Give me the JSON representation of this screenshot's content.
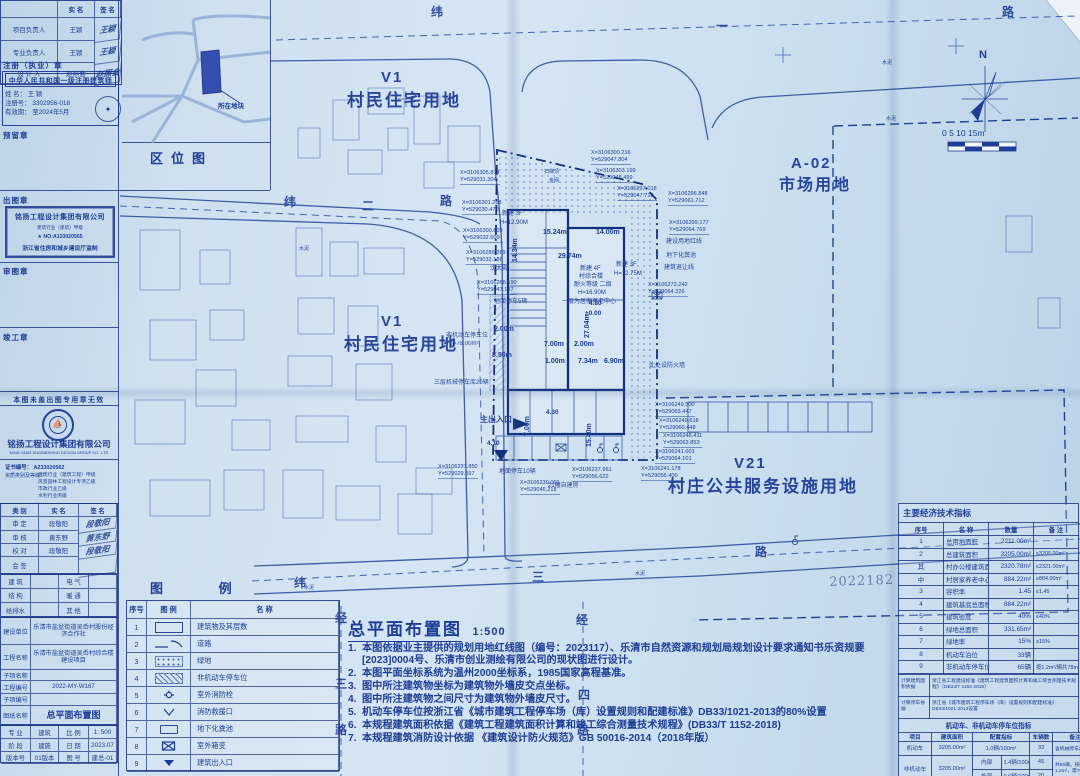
{
  "title_block": {
    "sign_table": {
      "headers": [
        "",
        "实 名",
        "签 名"
      ],
      "rows": [
        [
          "项目负责人",
          "王颖",
          "王颖"
        ],
        [
          "专业负责人",
          "王颖",
          "王颖"
        ],
        [
          "设 计 人",
          "赵照会",
          "赵照会"
        ]
      ]
    },
    "reg_stamp_label": "注册（执业）章",
    "reg_stamp": {
      "title": "中华人民共和国一级注册建筑师",
      "name": "姓 名： 王 颖",
      "no": "注册号： 3302956-018",
      "valid": "有效期： 至2024年5月"
    },
    "reserved_stamp_label": "预留章",
    "chutu_label": "出图章",
    "chutu_stamp": {
      "company": "铭扬工程设计集团有限公司",
      "grade": "建筑行业（建筑）甲级",
      "no": "★ NO:A133020565",
      "footer": "浙江省住房和城乡建设厅监制"
    },
    "shentu_label": "审图章",
    "jungong_label": "竣工章",
    "warning": "本图未盖出图专用章无效",
    "company_cn": "铭扬工程设计集团有限公司",
    "company_en": "MING YANG ENGINEERING DESIGN GROUP CO. ,LTD",
    "cert_no": "证书编号： A233020562",
    "cert_grade_label": "资质类别及等级：",
    "cert_grades": [
      "建筑行业（建筑工程）甲级",
      "风景园林工程设计专项乙级",
      "市政行业乙级",
      "水利行业丙级"
    ],
    "review_table": {
      "headers": [
        "类 别",
        "实 名",
        "签 名"
      ],
      "rows": [
        [
          "审 定",
          "段敬阳",
          "段敬阳"
        ],
        [
          "审 核",
          "黄东野",
          "黄东野"
        ],
        [
          "校 对",
          "段敬阳",
          "段敬阳"
        ],
        [
          "会 签",
          "",
          ""
        ]
      ]
    },
    "discipline_rows": [
      [
        "建 筑",
        "",
        "电 气",
        ""
      ],
      [
        "结 构",
        "",
        "暖 通",
        ""
      ],
      [
        "给排水",
        "",
        "其 他",
        ""
      ]
    ],
    "project_rows": [
      [
        "建设单位",
        "乐清市盐盆街道吴岙村股份经济合作社"
      ],
      [
        "工程名称",
        "乐清市盐盆街道吴岙村综合楼建设项目"
      ],
      [
        "子项名称",
        ""
      ],
      [
        "工程编号",
        "2022-MY-W167"
      ],
      [
        "子项编号",
        ""
      ],
      [
        "图纸名称",
        "总平面布置图"
      ]
    ],
    "bottom_rows": [
      [
        "专 业",
        "建筑",
        "比 例",
        "1: 500"
      ],
      [
        "阶 段",
        "建施",
        "日 期",
        "2023.07"
      ],
      [
        "版本号",
        "01版本",
        "图 号",
        "建总-01"
      ]
    ]
  },
  "location_map": {
    "caption": "区位图",
    "parcel_label": "所在地块"
  },
  "map": {
    "compass_n": "N",
    "scale_text": "0   5   10  15m",
    "stamp_number": "2022182",
    "zones": [
      {
        "t": "V1",
        "x": 381,
        "y": 70,
        "s": 15
      },
      {
        "t": "村民住宅用地",
        "x": 347,
        "y": 92,
        "s": 17
      },
      {
        "t": "A-02",
        "x": 791,
        "y": 156,
        "s": 15
      },
      {
        "t": "市场用地",
        "x": 779,
        "y": 178,
        "s": 16
      },
      {
        "t": "V1",
        "x": 381,
        "y": 314,
        "s": 15
      },
      {
        "t": "村民住宅用地",
        "x": 344,
        "y": 336,
        "s": 17
      },
      {
        "t": "V21",
        "x": 734,
        "y": 456,
        "s": 15
      },
      {
        "t": "村庄公共服务设施用地",
        "x": 668,
        "y": 478,
        "s": 17
      }
    ],
    "road_chars": [
      {
        "t": "纬",
        "x": 431,
        "y": 6
      },
      {
        "t": "一",
        "x": 716,
        "y": 20
      },
      {
        "t": "路",
        "x": 1002,
        "y": 6
      },
      {
        "t": "纬",
        "x": 284,
        "y": 196
      },
      {
        "t": "二",
        "x": 362,
        "y": 200
      },
      {
        "t": "路",
        "x": 440,
        "y": 195
      },
      {
        "t": "纬",
        "x": 294,
        "y": 577
      },
      {
        "t": "三",
        "x": 532,
        "y": 571
      },
      {
        "t": "路",
        "x": 755,
        "y": 546
      },
      {
        "t": "经",
        "x": 335,
        "y": 612
      },
      {
        "t": "三",
        "x": 335,
        "y": 678
      },
      {
        "t": "路",
        "x": 335,
        "y": 724
      },
      {
        "t": "经",
        "x": 576,
        "y": 614
      },
      {
        "t": "四",
        "x": 578,
        "y": 689
      },
      {
        "t": "路",
        "x": 577,
        "y": 724
      }
    ],
    "dims": [
      {
        "t": "15.24m",
        "x": 543,
        "y": 229
      },
      {
        "t": "14.00m",
        "x": 596,
        "y": 229
      },
      {
        "t": "29.74m",
        "x": 558,
        "y": 253
      },
      {
        "t": "7.00m",
        "x": 544,
        "y": 341
      },
      {
        "t": "2.00m",
        "x": 574,
        "y": 341
      },
      {
        "t": "1.00m",
        "x": 545,
        "y": 358
      },
      {
        "t": "7.34m",
        "x": 578,
        "y": 358
      },
      {
        "t": "6.90m",
        "x": 604,
        "y": 358
      },
      {
        "t": "2.00m",
        "x": 494,
        "y": 326
      },
      {
        "t": "8.90m",
        "x": 492,
        "y": 352
      },
      {
        "t": "4.80",
        "x": 589,
        "y": 301,
        "s": 6.5
      },
      {
        "t": "±0.00",
        "x": 585,
        "y": 311,
        "s": 6.5
      },
      {
        "t": "4.30",
        "x": 546,
        "y": 410,
        "s": 6.5
      },
      {
        "t": "4.10",
        "x": 487,
        "y": 441,
        "s": 6.5
      },
      {
        "t": "27.04m",
        "x": 584,
        "y": 338,
        "r": 1
      },
      {
        "t": "14.34m",
        "x": 512,
        "y": 262,
        "r": 1
      },
      {
        "t": "7.00m",
        "x": 524,
        "y": 436,
        "r": 1
      },
      {
        "t": "15.40m",
        "x": 586,
        "y": 447,
        "r": 1
      }
    ],
    "annotations": [
      {
        "t": "沈太殿",
        "x": 490,
        "y": 266
      },
      {
        "t": "地面停车5辆",
        "x": 494,
        "y": 299
      },
      {
        "t": "非机动车停车位",
        "x": 446,
        "y": 333
      },
      {
        "t": "S=78.00m²",
        "x": 449,
        "y": 341
      },
      {
        "t": "三层机械停车库20辆",
        "x": 434,
        "y": 380
      },
      {
        "t": "地面停车10辆",
        "x": 499,
        "y": 469
      },
      {
        "t": "21幢自建房",
        "x": 548,
        "y": 483
      },
      {
        "t": "建设用地红线",
        "x": 666,
        "y": 239
      },
      {
        "t": "地下化粪池",
        "x": 666,
        "y": 253
      },
      {
        "t": "建筑退让线",
        "x": 664,
        "y": 265
      },
      {
        "t": "此处设防火墙",
        "x": 649,
        "y": 363
      },
      {
        "t": "石梯顶",
        "x": 544,
        "y": 170,
        "s": 5
      },
      {
        "t": "金网",
        "x": 549,
        "y": 179,
        "s": 5
      },
      {
        "t": "主出入口",
        "x": 480,
        "y": 416,
        "s": 8,
        "b": 1
      },
      {
        "t": "水泥",
        "x": 299,
        "y": 247,
        "s": 5
      },
      {
        "t": "水泥",
        "x": 882,
        "y": 61,
        "s": 5
      },
      {
        "t": "水泥",
        "x": 886,
        "y": 117,
        "s": 5
      },
      {
        "t": "水泥",
        "x": 635,
        "y": 572,
        "s": 5
      },
      {
        "t": "水泥",
        "x": 304,
        "y": 586,
        "s": 5
      }
    ],
    "building_labels": [
      {
        "t": "新建 3F",
        "x": 502,
        "y": 211
      },
      {
        "t": "H=12.90M",
        "x": 500,
        "y": 220
      },
      {
        "t": "新建 4F",
        "x": 580,
        "y": 266
      },
      {
        "t": "村综合楼",
        "x": 579,
        "y": 274
      },
      {
        "t": "耐火等级 二级",
        "x": 574,
        "y": 282
      },
      {
        "t": "H=16.90M",
        "x": 578,
        "y": 290
      },
      {
        "t": "一层为居家养老中心",
        "x": 562,
        "y": 299
      },
      {
        "t": "新建 3F",
        "x": 616,
        "y": 262
      },
      {
        "t": "H=12.75M",
        "x": 614,
        "y": 271
      }
    ],
    "coords": [
      {
        "x": 591,
        "y": 150,
        "X": "X=3106300.216",
        "Y": "Y=529047.804"
      },
      {
        "x": 596,
        "y": 168,
        "X": "X=3106303.199",
        "Y": "Y=529048.499"
      },
      {
        "x": 617,
        "y": 186,
        "X": "X=3106297.018",
        "Y": "Y=529047.718"
      },
      {
        "x": 668,
        "y": 191,
        "X": "X=3106296.848",
        "Y": "Y=529061.712"
      },
      {
        "x": 669,
        "y": 220,
        "X": "X=3106299.177",
        "Y": "Y=529064.769"
      },
      {
        "x": 460,
        "y": 170,
        "X": "X=3106305.834",
        "Y": "Y=529031.304"
      },
      {
        "x": 462,
        "y": 200,
        "X": "X=3106301.268",
        "Y": "Y=529030.470"
      },
      {
        "x": 463,
        "y": 228,
        "X": "X=3106300.639",
        "Y": "Y=529032.509"
      },
      {
        "x": 466,
        "y": 250,
        "X": "X=3106286.369",
        "Y": "Y=529032.186"
      },
      {
        "x": 477,
        "y": 280,
        "X": "X=3106268.190",
        "Y": "Y=529047.187"
      },
      {
        "x": 648,
        "y": 282,
        "X": "X=3106273.242",
        "Y": "Y=529064.326"
      },
      {
        "x": 655,
        "y": 402,
        "X": "X=3106249.500",
        "Y": "Y=529063.447"
      },
      {
        "x": 659,
        "y": 418,
        "X": "X=3106249.618",
        "Y": "Y=529060.448"
      },
      {
        "x": 663,
        "y": 433,
        "X": "X=3106248.411",
        "Y": "Y=529063.853"
      },
      {
        "x": 655,
        "y": 449,
        "X": "X=3106241.601",
        "Y": "Y=529064.101"
      },
      {
        "x": 641,
        "y": 466,
        "X": "X=3106241.178",
        "Y": "Y=529056.400"
      },
      {
        "x": 572,
        "y": 467,
        "X": "X=3106237.961",
        "Y": "Y=529056.622"
      },
      {
        "x": 520,
        "y": 480,
        "X": "X=3106230.001",
        "Y": "Y=529046.218"
      },
      {
        "x": 438,
        "y": 464,
        "X": "X=3106237.850",
        "Y": "Y=529029.097"
      }
    ],
    "houses": [
      [
        333,
        100,
        26,
        40
      ],
      [
        368,
        88,
        36,
        26
      ],
      [
        414,
        96,
        26,
        48
      ],
      [
        448,
        126,
        32,
        36
      ],
      [
        298,
        128,
        22,
        30
      ],
      [
        348,
        150,
        34,
        24
      ],
      [
        424,
        162,
        30,
        26
      ],
      [
        388,
        128,
        20,
        22
      ],
      [
        296,
        228,
        26,
        48
      ],
      [
        330,
        242,
        28,
        34
      ],
      [
        364,
        248,
        40,
        26
      ],
      [
        298,
        298,
        36,
        36
      ],
      [
        348,
        306,
        30,
        40
      ],
      [
        288,
        356,
        44,
        30
      ],
      [
        356,
        364,
        36,
        36
      ],
      [
        296,
        416,
        52,
        26
      ],
      [
        376,
        426,
        30,
        36
      ],
      [
        416,
        468,
        36,
        26
      ],
      [
        283,
        470,
        40,
        48
      ],
      [
        336,
        486,
        44,
        34
      ],
      [
        398,
        494,
        34,
        40
      ],
      [
        1006,
        216,
        26,
        36
      ],
      [
        1038,
        298,
        22,
        30
      ],
      [
        140,
        230,
        40,
        60
      ],
      [
        150,
        320,
        46,
        40
      ],
      [
        135,
        400,
        50,
        44
      ],
      [
        200,
        250,
        30,
        34
      ],
      [
        210,
        310,
        34,
        30
      ],
      [
        196,
        370,
        40,
        36
      ],
      [
        232,
        420,
        38,
        30
      ],
      [
        150,
        480,
        60,
        36
      ],
      [
        224,
        470,
        40,
        40
      ]
    ]
  },
  "legend": {
    "title": "图  例",
    "headers": [
      "序号",
      "图  例",
      "名  称"
    ],
    "rows": [
      [
        "1",
        "building",
        "建筑物及其层数"
      ],
      [
        "2",
        "road",
        "道路"
      ],
      [
        "3",
        "green",
        "绿地"
      ],
      [
        "4",
        "bike",
        "非机动车停车位"
      ],
      [
        "5",
        "hydrant",
        "室外消防栓"
      ],
      [
        "6",
        "rescue",
        "消防救援口"
      ],
      [
        "7",
        "septic",
        "地下化粪池"
      ],
      [
        "8",
        "transformer",
        "室外箱变"
      ],
      [
        "9",
        "entrance",
        "建筑出入口"
      ]
    ]
  },
  "notes": {
    "title": "总平面布置图",
    "scale": "1:500",
    "items": [
      "本图依据业主提供的规划用地红线图（编号：2023117）、乐清市自然资源和规划局规划设计要求通知书乐资规要[2023]0004号、乐清市创业测绘有限公司的现状图进行设计。",
      "本图平面坐标系统为温州2000坐标系，1985国家高程基准。",
      "图中所注建筑物坐标为建筑物外墙皮交点坐标。",
      "图中所注建筑物之间尺寸为建筑物外墙皮尺寸。",
      "机动车停车位按浙江省《城市建筑工程停车场（库）设置规则和配建标准》DB33/1021-2013的80%设置",
      "本规程建筑面积依据《建筑工程建筑面积计算和竣工综合测量技术规程》(DB33/T 1152-2018)",
      "本规程建筑消防设计依据 《建筑设计防火规范》GB 50016-2014（2018年版）"
    ]
  },
  "indicators": {
    "title": "主要经济技术指标",
    "headers": [
      "序号",
      "名  称",
      "数量",
      "备 注"
    ],
    "rows": [
      [
        "1",
        "总用地面积",
        "2211.00m²",
        ""
      ],
      [
        "2",
        "总建筑面积",
        "3205.00m²",
        "≤3205.00m²"
      ],
      [
        "其",
        "村办公楼建筑面积",
        "2320.78m²",
        "≤2321.00m²"
      ],
      [
        "中",
        "村居家养老中心建筑面积",
        "884.22m²",
        "≥884.00m²"
      ],
      [
        "3",
        "容积率",
        "1.45",
        "≤1.45"
      ],
      [
        "4",
        "建筑基底总面积",
        "884.22m²",
        ""
      ],
      [
        "5",
        "建筑密度",
        "40%",
        "≤40%"
      ],
      [
        "6",
        "绿地总面积",
        "331.65m²",
        ""
      ],
      [
        "7",
        "绿地率",
        "15%",
        "≥15%"
      ],
      [
        "8",
        "机动车泊位",
        "33辆",
        ""
      ],
      [
        "9",
        "非机动车停车位",
        "65辆",
        "按1.2m²/辆共78m²"
      ]
    ],
    "basis_rows": [
      [
        "计算建筑面积依据",
        "浙江省工程建设标准《建筑工程建筑面积计算和竣工综合测量技术规程》（DB33/T 1152-2018）"
      ],
      [
        "计算停车依据",
        "浙江省《城市建筑工程停车场（库）设置规则和配建标准》DB33/1021-2013设置"
      ]
    ]
  },
  "parking": {
    "title": "机动车、非机动车停车位指标",
    "headers": [
      "项目",
      "建筑面积",
      "配置指标",
      "车辆数",
      "备注"
    ],
    "motor": {
      "name": "机动车",
      "area": "3205.00m²",
      "index": "1.0辆/100m²",
      "count": "33",
      "remark": "含机械停车20辆"
    },
    "nonmotor": {
      "name": "非机动车",
      "area": "3205.00m²",
      "inner_label": "内部",
      "inner_index": "1.4辆/100m²",
      "inner_count": "45",
      "outer_label": "外部",
      "outer_index": "0.6辆/100m²",
      "outer_count": "20",
      "remark": "共65辆，按每辆1.2m²，需78m²"
    }
  }
}
